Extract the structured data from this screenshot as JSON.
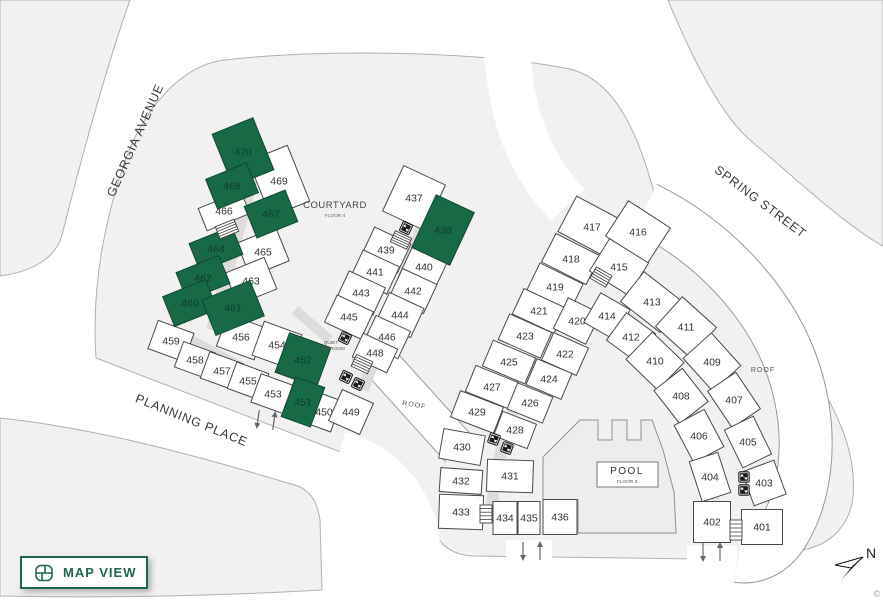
{
  "map_view_button": {
    "label": "MAP VIEW",
    "icon": "floorplan-icon"
  },
  "north": {
    "label": "N"
  },
  "attribution": "©",
  "colors": {
    "accent": "#1e6751",
    "selected_fill": "#186a47",
    "selected_text": "#0f3d28",
    "unit_fill": "#ffffff",
    "unit_stroke": "#4a4a4a",
    "unit_text": "#333333",
    "block_fill": "#f1f1f1",
    "block_stroke": "#b0b0b0",
    "corridor": "#dcdcdc",
    "street_text": "#3c3c3c"
  },
  "streets": [
    {
      "name": "GEORGIA AVENUE",
      "x": 139,
      "y": 142,
      "rot": -66
    },
    {
      "name": "SPRING STREET",
      "x": 758,
      "y": 205,
      "rot": 37
    },
    {
      "name": "PLANNING PLACE",
      "x": 190,
      "y": 424,
      "rot": 22
    }
  ],
  "areas": {
    "courtyard": {
      "label": "COURTYARD",
      "sublabel": "FLOOR 4",
      "x": 335,
      "y": 208
    },
    "clubroom": {
      "label": "QUIET",
      "label2": "CLUBROOM",
      "x": 331,
      "y": 346
    },
    "pool": {
      "label": "POOL",
      "sublabel": "FLOOR 2",
      "x": 627,
      "y": 462,
      "box": [
        597,
        462,
        61,
        25
      ]
    },
    "roof_labels": [
      {
        "label": "ROOF",
        "x": 414,
        "y": 407,
        "rot": 9
      },
      {
        "label": "ROOF",
        "x": 763,
        "y": 372,
        "rot": 0
      }
    ]
  },
  "units": [
    {
      "n": "470",
      "x": 243,
      "y": 152,
      "w": 44,
      "h": 56,
      "r": -22,
      "sel": true
    },
    {
      "n": "468",
      "x": 232,
      "y": 186,
      "w": 44,
      "h": 32,
      "r": -22,
      "sel": true
    },
    {
      "n": "469",
      "x": 279,
      "y": 181,
      "w": 42,
      "h": 60,
      "r": -22,
      "sel": false
    },
    {
      "n": "466",
      "x": 224,
      "y": 211,
      "w": 46,
      "h": 24,
      "r": -22,
      "sel": false
    },
    {
      "n": "467",
      "x": 271,
      "y": 214,
      "w": 44,
      "h": 34,
      "r": -22,
      "sel": true
    },
    {
      "n": "464",
      "x": 216,
      "y": 249,
      "w": 46,
      "h": 30,
      "r": -22,
      "sel": true
    },
    {
      "n": "465",
      "x": 263,
      "y": 252,
      "w": 42,
      "h": 36,
      "r": -22,
      "sel": false
    },
    {
      "n": "462",
      "x": 203,
      "y": 278,
      "w": 46,
      "h": 30,
      "r": -22,
      "sel": true
    },
    {
      "n": "463",
      "x": 251,
      "y": 281,
      "w": 42,
      "h": 34,
      "r": -22,
      "sel": false
    },
    {
      "n": "460",
      "x": 190,
      "y": 303,
      "w": 46,
      "h": 32,
      "r": -22,
      "sel": true
    },
    {
      "n": "461",
      "x": 233,
      "y": 308,
      "w": 52,
      "h": 38,
      "r": -22,
      "sel": true
    },
    {
      "n": "459",
      "x": 171,
      "y": 341,
      "w": 38,
      "h": 30,
      "r": 20,
      "sel": false
    },
    {
      "n": "458",
      "x": 195,
      "y": 360,
      "w": 34,
      "h": 27,
      "r": 20,
      "sel": false
    },
    {
      "n": "457",
      "x": 222,
      "y": 371,
      "w": 36,
      "h": 28,
      "r": 20,
      "sel": false
    },
    {
      "n": "455",
      "x": 248,
      "y": 381,
      "w": 34,
      "h": 28,
      "r": 20,
      "sel": false
    },
    {
      "n": "456",
      "x": 241,
      "y": 337,
      "w": 40,
      "h": 34,
      "r": 20,
      "sel": false
    },
    {
      "n": "454",
      "x": 277,
      "y": 345,
      "w": 40,
      "h": 36,
      "r": 20,
      "sel": false
    },
    {
      "n": "453",
      "x": 273,
      "y": 394,
      "w": 36,
      "h": 30,
      "r": 20,
      "sel": false
    },
    {
      "n": "452",
      "x": 303,
      "y": 360,
      "w": 44,
      "h": 42,
      "r": 20,
      "sel": true
    },
    {
      "n": "451",
      "x": 303,
      "y": 402,
      "w": 31,
      "h": 42,
      "r": 20,
      "sel": true
    },
    {
      "n": "450",
      "x": 324,
      "y": 412,
      "w": 26,
      "h": 33,
      "r": 20,
      "sel": false
    },
    {
      "n": "449",
      "x": 351,
      "y": 412,
      "w": 34,
      "h": 34,
      "r": 24,
      "sel": false
    },
    {
      "n": "437",
      "x": 414,
      "y": 198,
      "w": 46,
      "h": 50,
      "r": 25,
      "sel": false
    },
    {
      "n": "438",
      "x": 443,
      "y": 230,
      "w": 42,
      "h": 58,
      "r": 25,
      "sel": true
    },
    {
      "n": "439",
      "x": 386,
      "y": 250,
      "w": 40,
      "h": 32,
      "r": 25,
      "sel": false
    },
    {
      "n": "440",
      "x": 424,
      "y": 267,
      "w": 38,
      "h": 34,
      "r": 25,
      "sel": false
    },
    {
      "n": "441",
      "x": 375,
      "y": 272,
      "w": 40,
      "h": 30,
      "r": 25,
      "sel": false
    },
    {
      "n": "442",
      "x": 413,
      "y": 291,
      "w": 38,
      "h": 32,
      "r": 25,
      "sel": false
    },
    {
      "n": "443",
      "x": 361,
      "y": 293,
      "w": 40,
      "h": 30,
      "r": 25,
      "sel": false
    },
    {
      "n": "444",
      "x": 400,
      "y": 315,
      "w": 38,
      "h": 32,
      "r": 25,
      "sel": false
    },
    {
      "n": "445",
      "x": 349,
      "y": 317,
      "w": 40,
      "h": 30,
      "r": 25,
      "sel": false
    },
    {
      "n": "446",
      "x": 387,
      "y": 337,
      "w": 38,
      "h": 30,
      "r": 25,
      "sel": false
    },
    {
      "n": "448",
      "x": 375,
      "y": 353,
      "w": 38,
      "h": 26,
      "r": 25,
      "sel": false
    },
    {
      "n": "417",
      "x": 592,
      "y": 227,
      "w": 56,
      "h": 40,
      "r": 28,
      "sel": false
    },
    {
      "n": "418",
      "x": 571,
      "y": 259,
      "w": 50,
      "h": 32,
      "r": 27,
      "sel": false
    },
    {
      "n": "419",
      "x": 555,
      "y": 287,
      "w": 48,
      "h": 30,
      "r": 26,
      "sel": false
    },
    {
      "n": "421",
      "x": 539,
      "y": 311,
      "w": 46,
      "h": 28,
      "r": 25,
      "sel": false
    },
    {
      "n": "423",
      "x": 525,
      "y": 336,
      "w": 46,
      "h": 28,
      "r": 24,
      "sel": false
    },
    {
      "n": "425",
      "x": 509,
      "y": 362,
      "w": 46,
      "h": 28,
      "r": 23,
      "sel": false
    },
    {
      "n": "427",
      "x": 492,
      "y": 387,
      "w": 46,
      "h": 28,
      "r": 22,
      "sel": false
    },
    {
      "n": "429",
      "x": 477,
      "y": 412,
      "w": 46,
      "h": 28,
      "r": 21,
      "sel": false
    },
    {
      "n": "430",
      "x": 462,
      "y": 447,
      "w": 42,
      "h": 30,
      "r": 10,
      "sel": false
    },
    {
      "n": "432",
      "x": 461,
      "y": 481,
      "w": 42,
      "h": 24,
      "r": 4,
      "sel": false
    },
    {
      "n": "433",
      "x": 461,
      "y": 512,
      "w": 44,
      "h": 34,
      "r": 2,
      "sel": false
    },
    {
      "n": "416",
      "x": 638,
      "y": 232,
      "w": 50,
      "h": 42,
      "r": 33,
      "sel": false
    },
    {
      "n": "415",
      "x": 619,
      "y": 267,
      "w": 46,
      "h": 38,
      "r": 32,
      "sel": false
    },
    {
      "n": "420",
      "x": 577,
      "y": 321,
      "w": 36,
      "h": 34,
      "r": 26,
      "sel": false
    },
    {
      "n": "422",
      "x": 565,
      "y": 354,
      "w": 38,
      "h": 30,
      "r": 24,
      "sel": false
    },
    {
      "n": "424",
      "x": 549,
      "y": 379,
      "w": 38,
      "h": 28,
      "r": 23,
      "sel": false
    },
    {
      "n": "426",
      "x": 530,
      "y": 403,
      "w": 38,
      "h": 28,
      "r": 22,
      "sel": false
    },
    {
      "n": "428",
      "x": 515,
      "y": 430,
      "w": 36,
      "h": 26,
      "r": 21,
      "sel": false
    },
    {
      "n": "431",
      "x": 510,
      "y": 476,
      "w": 46,
      "h": 32,
      "r": 2,
      "sel": false
    },
    {
      "n": "434",
      "x": 505,
      "y": 518,
      "w": 24,
      "h": 33,
      "r": 0,
      "sel": false
    },
    {
      "n": "435",
      "x": 529,
      "y": 518,
      "w": 22,
      "h": 33,
      "r": 0,
      "sel": false
    },
    {
      "n": "436",
      "x": 560,
      "y": 517,
      "w": 34,
      "h": 35,
      "r": 0,
      "sel": false
    },
    {
      "n": "414",
      "x": 607,
      "y": 316,
      "w": 34,
      "h": 34,
      "r": 30,
      "sel": false
    },
    {
      "n": "413",
      "x": 652,
      "y": 302,
      "w": 50,
      "h": 38,
      "r": 38,
      "sel": false
    },
    {
      "n": "412",
      "x": 631,
      "y": 337,
      "w": 36,
      "h": 34,
      "r": 36,
      "sel": false
    },
    {
      "n": "411",
      "x": 686,
      "y": 327,
      "w": 46,
      "h": 40,
      "r": 42,
      "sel": false
    },
    {
      "n": "410",
      "x": 655,
      "y": 361,
      "w": 44,
      "h": 38,
      "r": 44,
      "sel": false
    },
    {
      "n": "409",
      "x": 712,
      "y": 362,
      "w": 44,
      "h": 38,
      "r": 48,
      "sel": false
    },
    {
      "n": "408",
      "x": 681,
      "y": 396,
      "w": 42,
      "h": 36,
      "r": 52,
      "sel": false
    },
    {
      "n": "407",
      "x": 734,
      "y": 400,
      "w": 44,
      "h": 34,
      "r": 56,
      "sel": false
    },
    {
      "n": "406",
      "x": 699,
      "y": 436,
      "w": 42,
      "h": 34,
      "r": 62,
      "sel": false
    },
    {
      "n": "405",
      "x": 748,
      "y": 442,
      "w": 42,
      "h": 32,
      "r": 64,
      "sel": false
    },
    {
      "n": "404",
      "x": 710,
      "y": 477,
      "w": 42,
      "h": 30,
      "r": 72,
      "sel": false
    },
    {
      "n": "403",
      "x": 764,
      "y": 483,
      "w": 36,
      "h": 34,
      "r": 70,
      "sel": false
    },
    {
      "n": "402",
      "x": 712,
      "y": 522,
      "w": 37,
      "h": 41,
      "r": 0,
      "sel": false
    },
    {
      "n": "401",
      "x": 762,
      "y": 527,
      "w": 41,
      "h": 35,
      "r": 0,
      "sel": false
    }
  ],
  "stairs": [
    {
      "x": 227,
      "y": 229,
      "w": 20,
      "h": 13,
      "r": -22
    },
    {
      "x": 401,
      "y": 240,
      "w": 18,
      "h": 12,
      "r": 25
    },
    {
      "x": 362,
      "y": 364,
      "w": 18,
      "h": 13,
      "r": 25
    },
    {
      "x": 601,
      "y": 277,
      "w": 18,
      "h": 13,
      "r": 30
    },
    {
      "x": 486,
      "y": 514,
      "w": 12,
      "h": 18,
      "r": 0
    },
    {
      "x": 736,
      "y": 530,
      "w": 12,
      "h": 20,
      "r": 0
    }
  ],
  "elevators": [
    {
      "x": 406,
      "y": 228,
      "r": 25
    },
    {
      "x": 345,
      "y": 338,
      "r": 25
    },
    {
      "x": 346,
      "y": 377,
      "r": 25
    },
    {
      "x": 358,
      "y": 384,
      "r": 25
    },
    {
      "x": 494,
      "y": 439,
      "r": 20
    },
    {
      "x": 507,
      "y": 448,
      "r": 20
    },
    {
      "x": 744,
      "y": 477,
      "r": 0
    },
    {
      "x": 744,
      "y": 490,
      "r": 0
    }
  ],
  "entry_arrows": [
    {
      "x": 258,
      "y": 419,
      "dir": "down",
      "r": 8
    },
    {
      "x": 274,
      "y": 421,
      "dir": "up",
      "r": 8
    },
    {
      "x": 523,
      "y": 551,
      "dir": "down",
      "r": 0
    },
    {
      "x": 540,
      "y": 551,
      "dir": "up",
      "r": 0
    },
    {
      "x": 703,
      "y": 552,
      "dir": "down",
      "r": 0
    },
    {
      "x": 720,
      "y": 552,
      "dir": "up",
      "r": 0
    }
  ]
}
